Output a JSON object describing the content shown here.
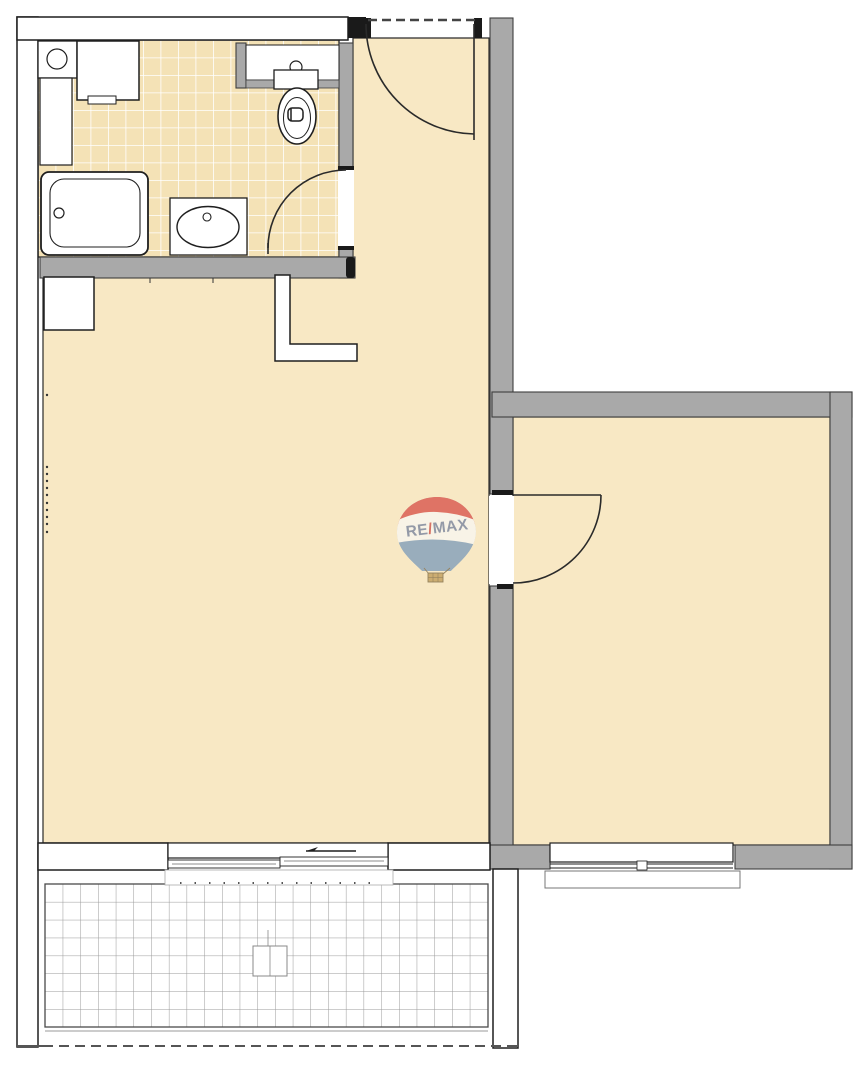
{
  "watermark": {
    "brand_full": "RE/MAX",
    "re": "RE",
    "slash": "/",
    "max": "MAX"
  },
  "colors": {
    "background": "#FFFFFF",
    "floor": "#F8E8C4",
    "bathroom_tile": "#F4E2B6",
    "bathroom_tile_grout": "#FFFFFF",
    "balcony_tile": "#FFFFFF",
    "balcony_tile_grout": "#9A9A9A",
    "wall_gray": "#A9A9A9",
    "wall_gray_edge": "#3F3F3F",
    "wall_outline": "#1F1F1F",
    "balloon_red": "#DD6A5E",
    "balloon_blue": "#92A8BC",
    "balloon_band": "#F9F5EA",
    "balloon_text": "#8B93A5",
    "balloon_slash": "#D4685C",
    "balloon_basket": "#C9A96A"
  }
}
